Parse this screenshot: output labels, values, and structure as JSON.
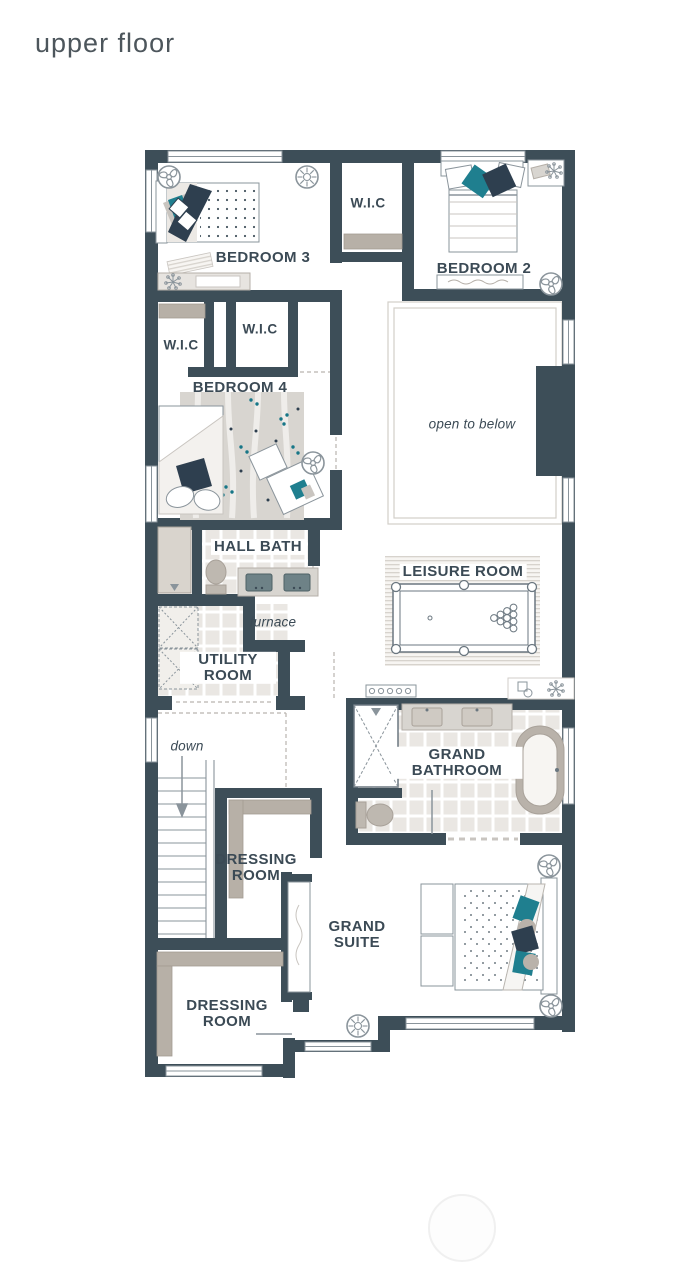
{
  "page": {
    "title": "upper floor"
  },
  "colors": {
    "wall": "#3d4e58",
    "label": "#3b4a55",
    "accent_teal": "#1f7f8f",
    "accent_navy": "#2e3f4f",
    "shelving": "#b7b0a7",
    "cabinet": "#d9d4cd",
    "tile": "#eae7e3",
    "line": "#8a949b"
  },
  "rooms": {
    "bedroom3": "BEDROOM 3",
    "wic_bedroom3": "W.I.C",
    "bedroom2": "BEDROOM 2",
    "wic_left": "W.I.C",
    "wic_bedroom4": "W.I.C",
    "bedroom4": "BEDROOM 4",
    "open_to_below": "open to below",
    "hall_bath": "HALL BATH",
    "leisure_room": "LEISURE ROOM",
    "furnace": "furnace",
    "utility_room": "UTILITY ROOM",
    "stairs_down": "down",
    "dressing_room_1": "DRESSING ROOM",
    "grand_bathroom": "GRAND BATHROOM",
    "grand_suite": "GRAND SUITE",
    "dressing_room_2": "DRESSING ROOM"
  }
}
